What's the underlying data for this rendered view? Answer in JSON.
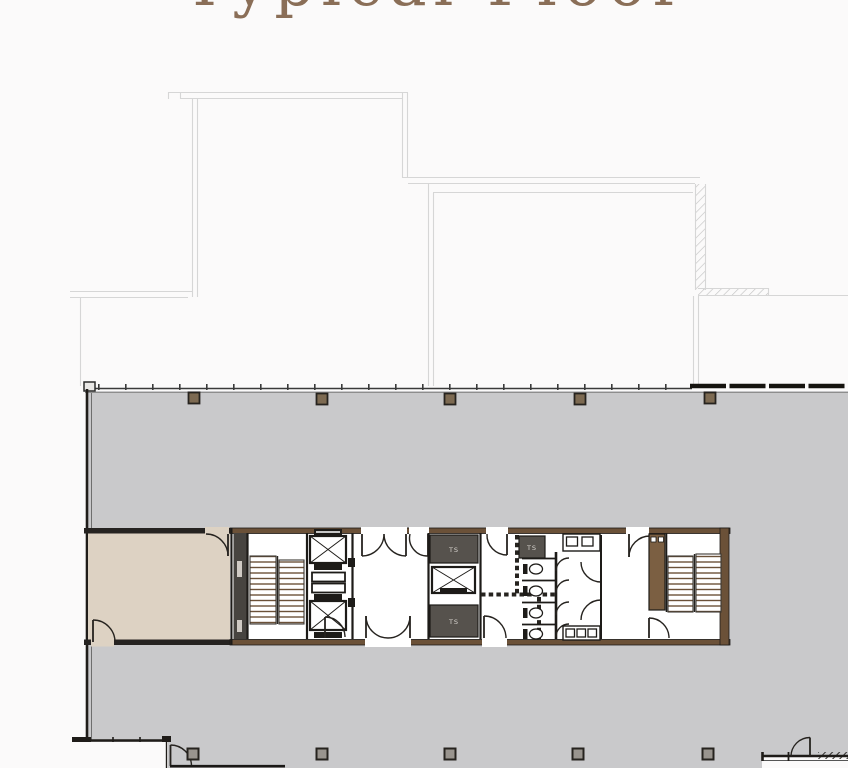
{
  "title": "Typical Floor",
  "plan": {
    "core": {
      "service_rooms": [
        {
          "label": "TS"
        },
        {
          "label": "TS"
        },
        {
          "label": "TS"
        }
      ]
    }
  },
  "colors": {
    "bg": "#fbfafa",
    "floor": "#c9c9cb",
    "beige": "#ddd2c3",
    "wall_brown": "#6b5138",
    "wall_dark": "#221f1c",
    "dark_room": "#56524d",
    "shaft_dark": "#474440",
    "line_faint": "#d6d6d6",
    "title_brown": "#8a6e57",
    "tread_line": "#6b5138",
    "column_top": "#7d6a52",
    "column_bottom": "#99948e",
    "label_light": "#d9d5d0"
  }
}
